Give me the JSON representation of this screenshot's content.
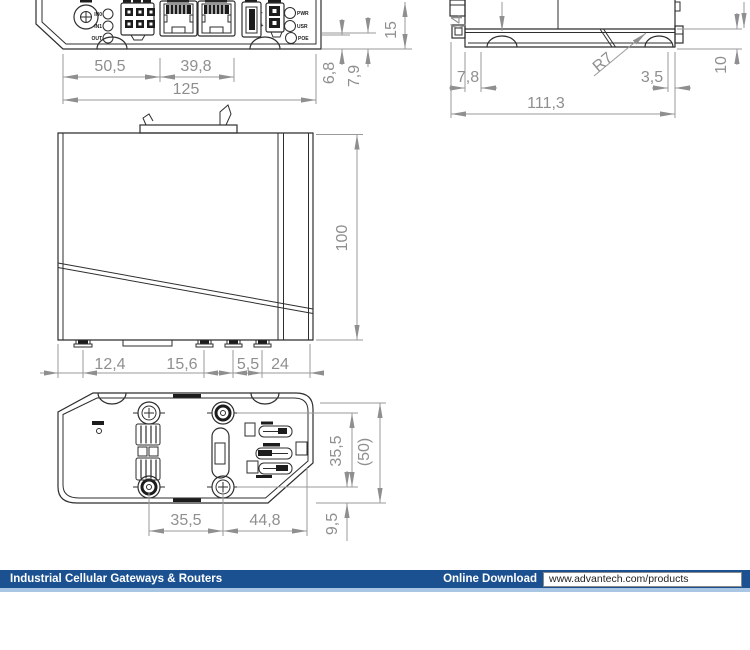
{
  "footer": {
    "title": "Industrial Cellular Gateways & Routers",
    "download_label": "Online Download",
    "url": "www.advantech.com/products",
    "bar_color": "#1b5191",
    "accent_color": "#a9c6e5"
  },
  "front_panel": {
    "in0": "IN0",
    "in1": "IN1",
    "out": "OUT",
    "led1": "PWR",
    "led2": "USR",
    "led3": "POE",
    "plus": "+",
    "minus": "-"
  },
  "dims_front": {
    "w1": "50,5",
    "w2": "39,8",
    "w_total": "125",
    "h1": "6,8",
    "h2": "7,9",
    "h3": "15"
  },
  "dims_side": {
    "cut": "(4",
    "radius": "R7",
    "o1": "7,8",
    "o2": "3,5",
    "total": "111,3",
    "h": "10"
  },
  "dims_left": {
    "height": "100",
    "s1": "12,4",
    "s2": "15,6",
    "s3": "5,5",
    "s4": "24"
  },
  "dims_bottom": {
    "w1": "35,5",
    "w2": "44,8",
    "v1": "35,5",
    "v2": "(50)",
    "v3": "9,5"
  },
  "drawing_colors": {
    "outline": "#2e2e2e",
    "dimension": "#8f8f8f"
  }
}
